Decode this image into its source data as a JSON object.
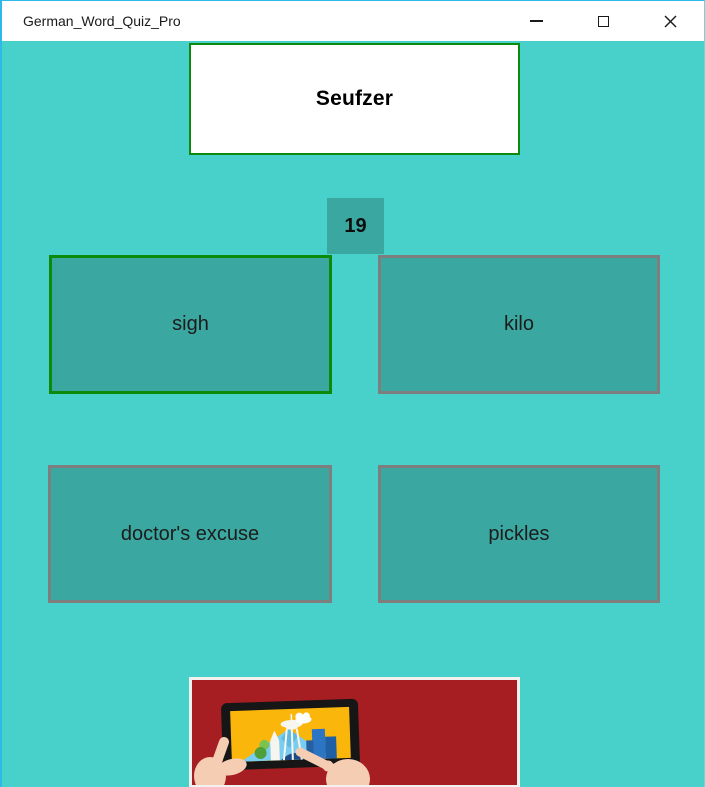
{
  "window": {
    "title": "German_Word_Quiz_Pro",
    "controls": {
      "minimize_icon": "minimize-dash",
      "maximize_icon": "maximize-square",
      "close_icon": "close-x"
    }
  },
  "quiz": {
    "prompt_word": "Seufzer",
    "counter": "19",
    "answers": [
      {
        "label": "sigh",
        "state": "correct"
      },
      {
        "label": "kilo",
        "state": "default"
      },
      {
        "label": "doctor's excuse",
        "state": "default"
      },
      {
        "label": "pickles",
        "state": "default"
      }
    ]
  },
  "ad": {
    "illustration_icon": "hands-holding-tablet-with-city-skyline"
  },
  "colors": {
    "background": "#48D1CA",
    "tile": "#3AA8A0",
    "tile_border": "#7E7E7E",
    "correct_border": "#0C8A0C",
    "accent_border": "#2FB9E9",
    "titlebar_bg": "#FFFFFF",
    "illustration_bg": "#A61D22",
    "frame": "#F3F1ED"
  }
}
